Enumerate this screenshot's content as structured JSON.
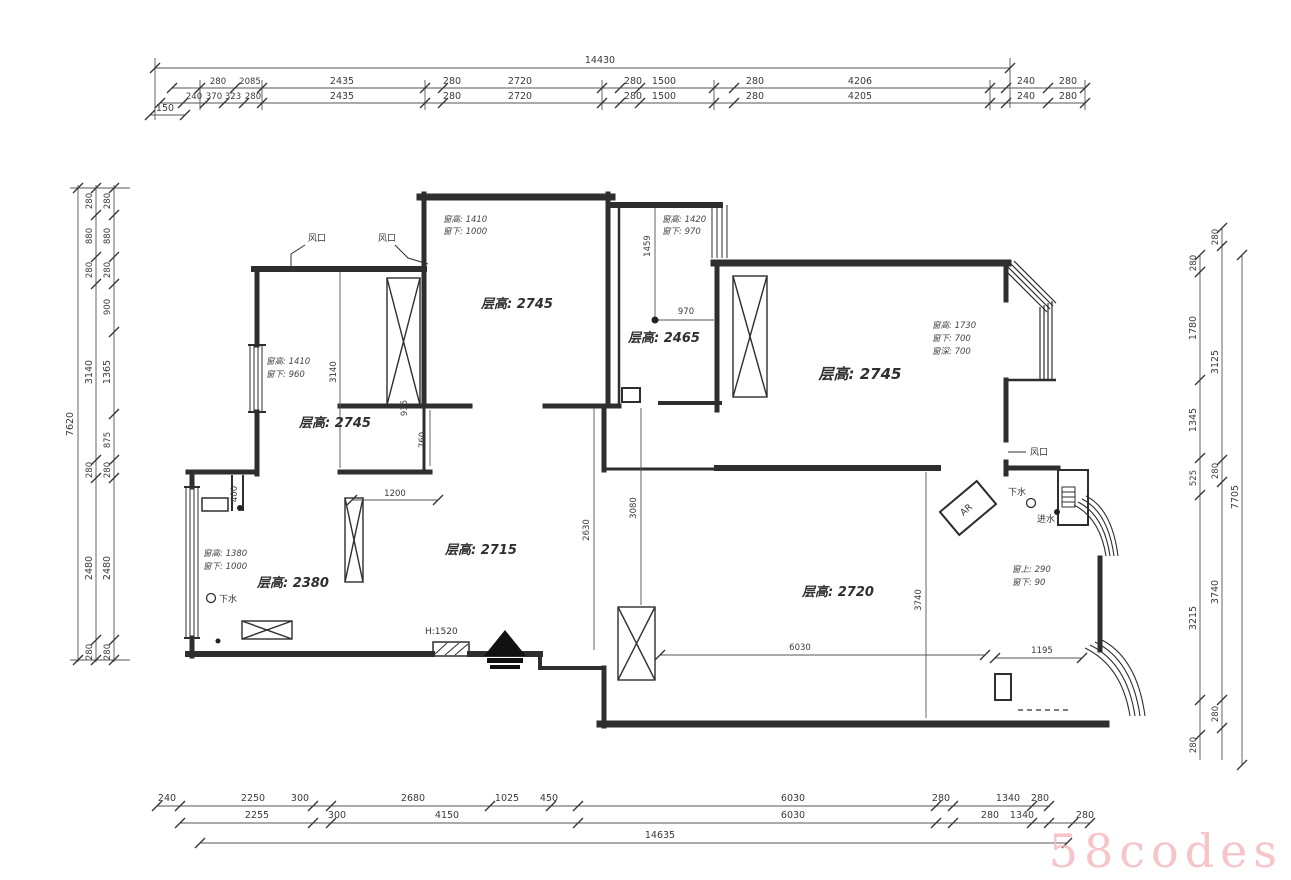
{
  "watermark": "58codes",
  "colors": {
    "wall": "#2e2e2e",
    "dimline": "#555555",
    "watermark": "#f6bcc0"
  },
  "dims": {
    "top": {
      "overall": "14430",
      "offset150": "150",
      "row2": [
        "280",
        "2085",
        "2435",
        "280",
        "2720",
        "280",
        "1500",
        "280",
        "4206",
        "240",
        "280"
      ],
      "row3": [
        "240",
        "370",
        "323",
        "280",
        "2435",
        "280",
        "2720",
        "280",
        "1500",
        "280",
        "4205",
        "240",
        "280"
      ]
    },
    "left": {
      "overall": "7620",
      "mid": [
        "280",
        "880",
        "280",
        "3140",
        "280",
        "2480",
        "280"
      ],
      "inner": [
        "280",
        "880",
        "280",
        "900",
        "1365",
        "875",
        "280",
        "2480",
        "280"
      ]
    },
    "right": {
      "overall": "7705",
      "mid": [
        "280",
        "3125",
        "280",
        "3740",
        "280"
      ],
      "inner": [
        "280",
        "1780",
        "1345",
        "525",
        "3215",
        "280"
      ]
    },
    "bottom": {
      "overall": "14635",
      "row1": [
        "240",
        "2250",
        "300",
        "2680",
        "1025",
        "450",
        "6030",
        "280",
        "1340",
        "280"
      ],
      "row2": [
        "2255",
        "300",
        "4150",
        "6030",
        "280",
        "1340",
        "280"
      ]
    },
    "interior": {
      "d3140": "3140",
      "d935": "935",
      "d760": "760",
      "d1200": "1200",
      "d400": "400",
      "d1459": "1459",
      "d970": "970",
      "d2630": "2630",
      "d3080": "3080",
      "d3740": "3740",
      "d6030": "6030",
      "d1195": "1195"
    }
  },
  "rooms": {
    "top_mid": "层高: 2745",
    "upper_left": "层高: 2745",
    "small_mid": "层高: 2465",
    "right_big": "层高: 2745",
    "center": "层高: 2715",
    "bottom_left": "层高: 2380",
    "bottom_right": "层高: 2720"
  },
  "window_notes": {
    "top_mid": [
      "窗高: 1410",
      "窗下: 1000"
    ],
    "small_mid": [
      "窗高: 1420",
      "窗下: 970"
    ],
    "upper_left": [
      "窗高: 1410",
      "窗下: 960"
    ],
    "right_big": [
      "窗高: 1730",
      "窗下: 700",
      "窗深: 700"
    ],
    "bottom_left": [
      "窗高: 1380",
      "窗下: 1000"
    ],
    "bottom_right": [
      "窗上: 290",
      "窗下: 90"
    ]
  },
  "labels": {
    "vent": "风口",
    "drain": "下水",
    "water_inlet": "进水",
    "ac_unit": "AR",
    "door_height": "H:1520"
  }
}
